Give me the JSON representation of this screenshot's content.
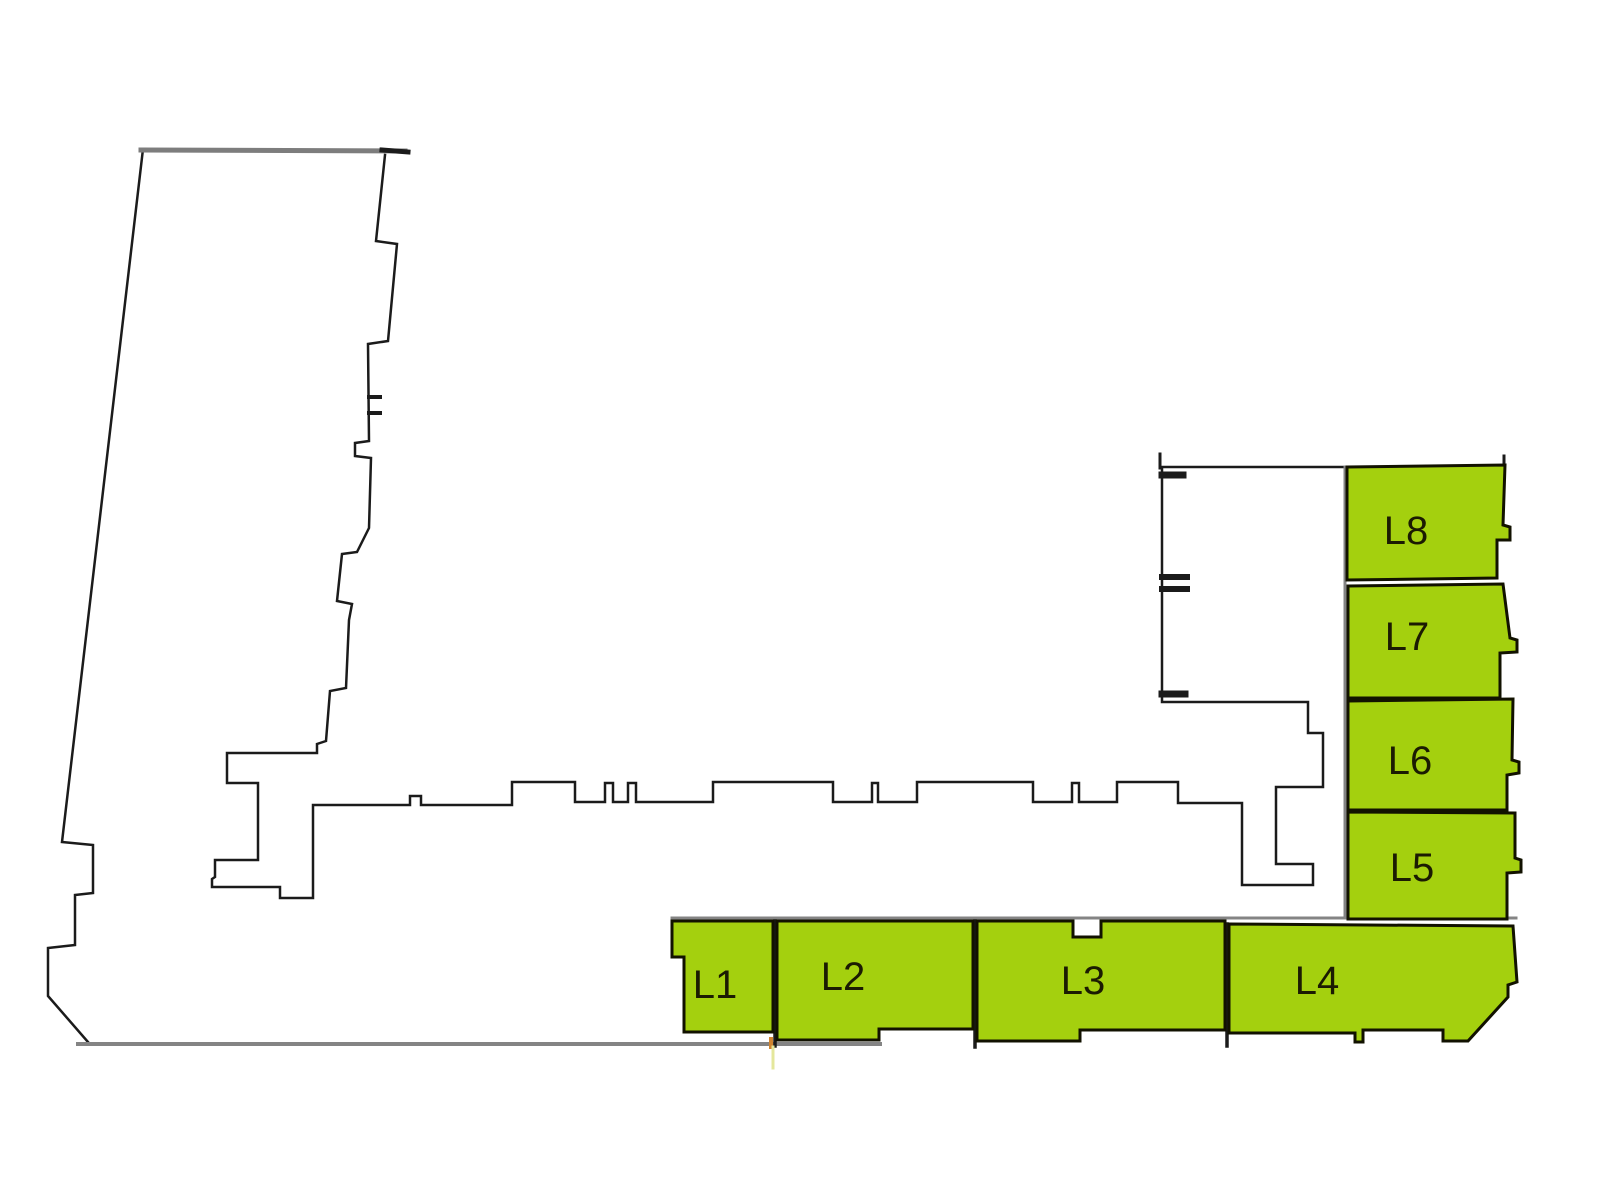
{
  "canvas": {
    "width": 1600,
    "height": 1200,
    "background": "#ffffff"
  },
  "palette": {
    "unit_fill": "#a4d00e",
    "unit_stroke": "#121200",
    "label_color": "#1b1b02",
    "dark": "#1b1b1b",
    "gray": "#848484",
    "top_gray": "#7d7d7d",
    "artifact_orange": "#cf8430",
    "artifact_yellow": "#e4e79c"
  },
  "units": [
    {
      "id": "L1",
      "label": "L1",
      "points": "672,921 773,921 773,1032 684,1032 684,957 672,957",
      "lx": 715,
      "ly": 985
    },
    {
      "id": "L2",
      "label": "L2",
      "points": "777,921 973,921 973,1029 879,1029 879,1040 777,1040",
      "lx": 843,
      "ly": 977
    },
    {
      "id": "L3",
      "label": "L3",
      "points": "977,921 1073,921 1073,937 1101,937 1101,921 1225,921 1225,1030 1080,1030 1080,1041 977,1041",
      "lx": 1083,
      "ly": 981
    },
    {
      "id": "L4",
      "label": "L4",
      "points": "1229,924 1513,926 1517,982 1508,985 1508,997 1468,1041 1443,1041 1443,1030 1363,1030 1363,1042 1355,1042 1355,1033 1229,1033",
      "lx": 1317,
      "ly": 981
    },
    {
      "id": "L5",
      "label": "L5",
      "points": "1348,812 1515,813 1515,858 1521,860 1521,872 1507,873 1507,919 1348,919",
      "lx": 1412,
      "ly": 868
    },
    {
      "id": "L6",
      "label": "L6",
      "points": "1348,701 1513,699 1512,760 1519,762 1519,773 1507,775 1507,810 1348,810",
      "lx": 1410,
      "ly": 761
    },
    {
      "id": "L7",
      "label": "L7",
      "points": "1348,586 1503,584 1510,638 1517,640 1517,652 1500,653 1500,698 1348,698",
      "lx": 1407,
      "ly": 637
    },
    {
      "id": "L8",
      "label": "L8",
      "points": "1347,467 1505,465 1503,525 1510,527 1510,540 1497,540 1497,578 1347,580",
      "lx": 1406,
      "ly": 531
    }
  ],
  "walls": [
    {
      "name": "site-left-edge",
      "color": "dark",
      "w": 2.5,
      "pts": "88,1042 48,996 48,948 75,945 75,895 93,893 93,845 62,842 143,149"
    },
    {
      "name": "building-top-edge",
      "color": "top_gray",
      "w": 5,
      "pts": "141,150 405,151"
    },
    {
      "name": "building-top-edge-cap",
      "color": "dark",
      "w": 5,
      "pts": "382,150 408,152"
    },
    {
      "name": "building-outline",
      "color": "dark",
      "w": 2.5,
      "pts": "385,155 376,241 397,244 388,341 368,344 369,441 355,443 355,456 371,458 369,528 357,552 342,554 337,601 352,604 349,620 346,688 330,691 326,741 317,744 317,753 227,753 227,783 258,783 258,860 215,860 215,877 212,879 212,887 280,887 280,898 313,898 313,805 410,805 410,796 421,796 421,805 512,805 512,782 575,782 575,802 605,802 605,783 613,783 613,802 628,802 628,783 636,783 636,802 713,802 713,782 833,782 833,802 872,802 872,783 878,783 878,802 917,802 917,782 1033,782 1033,802 1072,802 1072,783 1079,783 1079,802 1117,802 1117,782 1178,782 1178,803 1242,803 1242,885 1313,885 1313,864 1276,864 1276,787 1323,787 1323,733 1308,733 1308,702 1162,702 1162,467 1347,467"
    },
    {
      "name": "door-tick-tower-upper",
      "color": "dark",
      "w": 4,
      "pts": "369,397 380,397"
    },
    {
      "name": "door-tick-tower-lower",
      "color": "dark",
      "w": 4,
      "pts": "369,413 380,413"
    },
    {
      "name": "tab-northwing-top",
      "color": "dark",
      "w": 7,
      "pts": "1162,475 1183,475"
    },
    {
      "name": "tab-northwing-mid-upper",
      "color": "dark",
      "w": 6,
      "pts": "1162,577 1187,577"
    },
    {
      "name": "tab-northwing-mid-lower",
      "color": "dark",
      "w": 6,
      "pts": "1162,589 1187,589"
    },
    {
      "name": "tab-northwing-bottom",
      "color": "dark",
      "w": 7,
      "pts": "1162,694 1185,694"
    },
    {
      "name": "corner-tick-northwing",
      "color": "dark",
      "w": 3,
      "pts": "1160,454 1160,468"
    },
    {
      "name": "corner-tick-L8",
      "color": "dark",
      "w": 3,
      "pts": "1504,456 1504,467"
    },
    {
      "name": "site-bottom-line",
      "color": "gray",
      "w": 4,
      "pts": "78,1044 880,1044"
    },
    {
      "name": "units-top-separator",
      "color": "gray",
      "w": 3,
      "pts": "672,918 1516,918"
    },
    {
      "name": "column-left-separator",
      "color": "gray",
      "w": 3,
      "pts": "1345,467 1345,918"
    },
    {
      "name": "unit-wall-L1-L2",
      "color": "dark",
      "w": 3.5,
      "pts": "775,921 775,1046"
    },
    {
      "name": "unit-wall-L2-L3",
      "color": "dark",
      "w": 3.5,
      "pts": "975,921 975,1047"
    },
    {
      "name": "unit-wall-L3-L4",
      "color": "dark",
      "w": 3.5,
      "pts": "1227,924 1227,1046"
    },
    {
      "name": "artifact-orange-tick",
      "color": "artifact_orange",
      "w": 4,
      "pts": "771,1039 771,1047"
    },
    {
      "name": "artifact-yellow-tick",
      "color": "artifact_yellow",
      "w": 3,
      "pts": "773,1047 773,1068"
    }
  ]
}
